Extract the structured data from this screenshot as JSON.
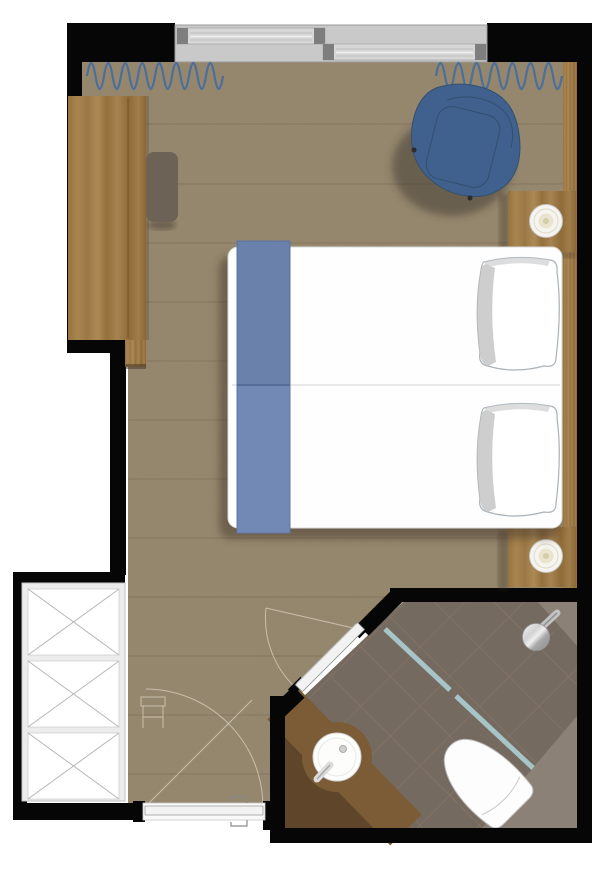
{
  "title": "hotel-guest-room-floor-plan",
  "rooms": [
    {
      "name": "bedroom"
    },
    {
      "name": "bathroom"
    },
    {
      "name": "wardrobe-niche"
    }
  ],
  "furniture": [
    {
      "name": "double-bed",
      "parts": [
        "mattress",
        "center-seam",
        "bed-runner",
        "pillow-left",
        "pillow-right"
      ]
    },
    {
      "name": "armchair"
    },
    {
      "name": "desk-console"
    },
    {
      "name": "desk-stool"
    },
    {
      "name": "nightstand-top",
      "parts": [
        "table-lamp"
      ]
    },
    {
      "name": "nightstand-bottom",
      "parts": [
        "table-lamp"
      ]
    },
    {
      "name": "wardrobe",
      "sections": 3
    },
    {
      "name": "toilet"
    },
    {
      "name": "round-sink-vanity",
      "parts": [
        "basin",
        "faucet",
        "drain"
      ]
    },
    {
      "name": "shower-head"
    },
    {
      "name": "shower-glass-partition"
    }
  ],
  "openings": [
    {
      "name": "sliding-window",
      "panels": 2
    },
    {
      "name": "entry-door",
      "state": "closed",
      "swing_arc": true
    },
    {
      "name": "bathroom-door",
      "state": "closed",
      "swing_arc": true
    },
    {
      "name": "curtain-left",
      "style": "wave"
    },
    {
      "name": "curtain-right",
      "style": "wave"
    }
  ],
  "palette": {
    "wall": "#060606",
    "carpet": "#97896F",
    "carpet_seam": "rgba(95,80,58,0.30)",
    "bathroom_floor": "#756A60",
    "bathroom_floor_light": "#8B8177",
    "tile_line": "rgba(155,130,105,0.50)",
    "glass": "#A7C5C9",
    "runner_blue": "#7289B5",
    "runner_edge": "#5E77A4",
    "chair_blue": "#40618D",
    "chair_line": "#32506F",
    "curtain_blue": "#4C6E9B",
    "wood_desk": "#A5824D",
    "wood_panel": "#93703C",
    "wood_vanity": "#7B5C36",
    "stool": "#6C6255",
    "bed_white": "#FEFEFE",
    "pillow_shade": "#C6C6C6",
    "lamp_cream": "#EAE3CD",
    "fixture_white": "#FDFDFD",
    "chrome_light": "#F2F2F2",
    "chrome_dark": "#8A8A8A",
    "window_frame": "#C9C9C9",
    "window_panel": "#D7D7D7",
    "window_handle": "#7E7E7E",
    "wardrobe_frame": "#ECECEC",
    "wardrobe_x": "#B6B6B6",
    "ghost_line": "rgba(228,221,207,0.65)",
    "background": "#FFFFFF"
  }
}
